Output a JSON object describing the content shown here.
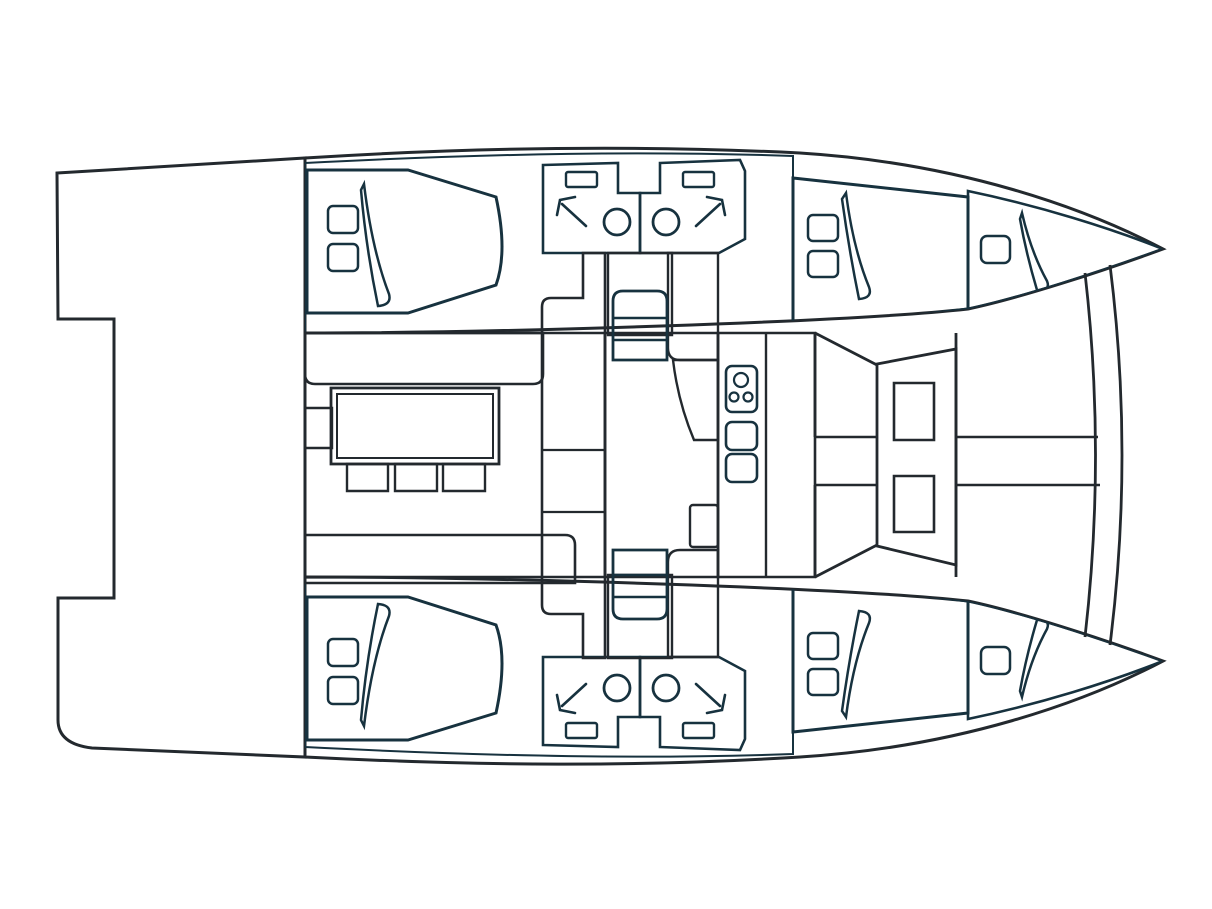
{
  "diagram": {
    "type": "catamaran-deck-plan",
    "orientation": "bow-right-stern-left"
  },
  "palette": {
    "background": "#ffffff",
    "white": "#ffffff",
    "outline": "#23292e",
    "navy": "#17323f",
    "aft_deck": "#b7a88e",
    "cockpit_seat": "#c3b299",
    "cabin_floor": "#a2d4e4",
    "bed": "#7db2c6",
    "bow_deck": "#c0d2d8",
    "bathroom": "#c5da9a",
    "sole": "#f6d78c",
    "faucet": "#111111"
  },
  "regions": [
    {
      "name": "aft-deck",
      "fill": "aft_deck"
    },
    {
      "name": "port-hull",
      "fill": "white"
    },
    {
      "name": "starboard-hull",
      "fill": "white"
    },
    {
      "name": "cabin-floor",
      "fill": "cabin_floor"
    },
    {
      "name": "double-bed",
      "fill": "bed"
    },
    {
      "name": "bathroom",
      "fill": "bathroom"
    },
    {
      "name": "saloon-sole",
      "fill": "sole"
    },
    {
      "name": "galley",
      "fill": "white"
    },
    {
      "name": "forward-cockpit-seat",
      "fill": "cockpit_seat"
    },
    {
      "name": "bow-deck",
      "fill": "bow_deck"
    }
  ],
  "features": {
    "cabins": 4,
    "double_beds": 4,
    "pillows": 8,
    "bathrooms": 4,
    "toilets": 4,
    "hand_basins": 4,
    "showers": 4,
    "staircases": 2,
    "galley_burners": 3,
    "galley_sinks": 2,
    "saloon_tables": 1,
    "saloon_stools": 3,
    "cockpit_tables": 2,
    "bow_hatches": 2
  }
}
